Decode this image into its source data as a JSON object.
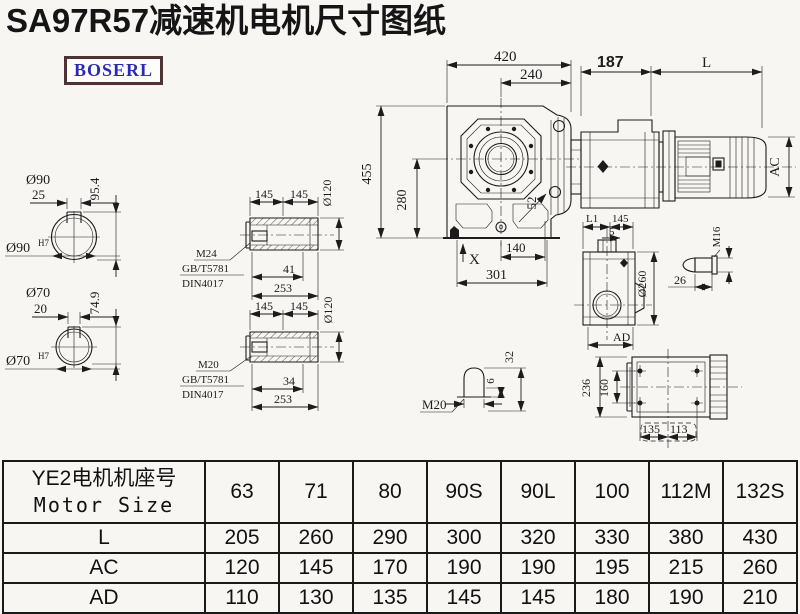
{
  "title": "SA97R57减速机电机尺寸图纸",
  "logo": {
    "text": "BOSERL"
  },
  "colors": {
    "ink": "#1c1c1c",
    "title": "#151515",
    "logo_text": "#2a2ab4",
    "logo_border": "#4c3434",
    "background": "#f7f6f3"
  },
  "shaft1": {
    "dia": "Ø90",
    "kw": "25",
    "kh": "95.4",
    "bore": "Ø90",
    "tol": "H7"
  },
  "shaft2": {
    "dia": "Ø70",
    "kw": "20",
    "kh": "74.9",
    "bore": "Ø70",
    "tol": "H7"
  },
  "hollow1": {
    "s1": "145",
    "s2": "145",
    "dia": "Ø120",
    "thread": "M24",
    "std1": "GB/T5781",
    "std2": "DIN4017",
    "a": "41",
    "b": "253"
  },
  "hollow2": {
    "s1": "145",
    "s2": "145",
    "dia": "Ø120",
    "thread": "M20",
    "std1": "GB/T5781",
    "std2": "DIN4017",
    "a": "34",
    "b": "253"
  },
  "front_view": {
    "w": "420",
    "w2": "240",
    "h": "455",
    "h2": "280",
    "slant": "52",
    "x": "X",
    "b1": "140",
    "b2": "301"
  },
  "side_view": {
    "front": "187",
    "l": "L",
    "ac": "AC"
  },
  "output_view": {
    "l1": "L1",
    "w": "145",
    "off": "5",
    "dia": "Ø260",
    "ad": "AD"
  },
  "bolt": {
    "thread": "M16",
    "len": "26"
  },
  "plug": {
    "thread": "M20",
    "a": "6",
    "b": "32"
  },
  "top_view": {
    "h": "236",
    "hh": "160",
    "b1": "135",
    "b2": "113"
  },
  "table": {
    "header_line1": "YE2电机机座号",
    "header_line2": "Motor Size",
    "columns": [
      "63",
      "71",
      "80",
      "90S",
      "90L",
      "100",
      "112M",
      "132S"
    ],
    "rows": [
      {
        "label": "L",
        "values": [
          "205",
          "260",
          "290",
          "300",
          "320",
          "330",
          "380",
          "430"
        ]
      },
      {
        "label": "AC",
        "values": [
          "120",
          "145",
          "170",
          "190",
          "190",
          "195",
          "215",
          "260"
        ]
      },
      {
        "label": "AD",
        "values": [
          "110",
          "130",
          "135",
          "145",
          "145",
          "180",
          "190",
          "210"
        ]
      }
    ]
  }
}
